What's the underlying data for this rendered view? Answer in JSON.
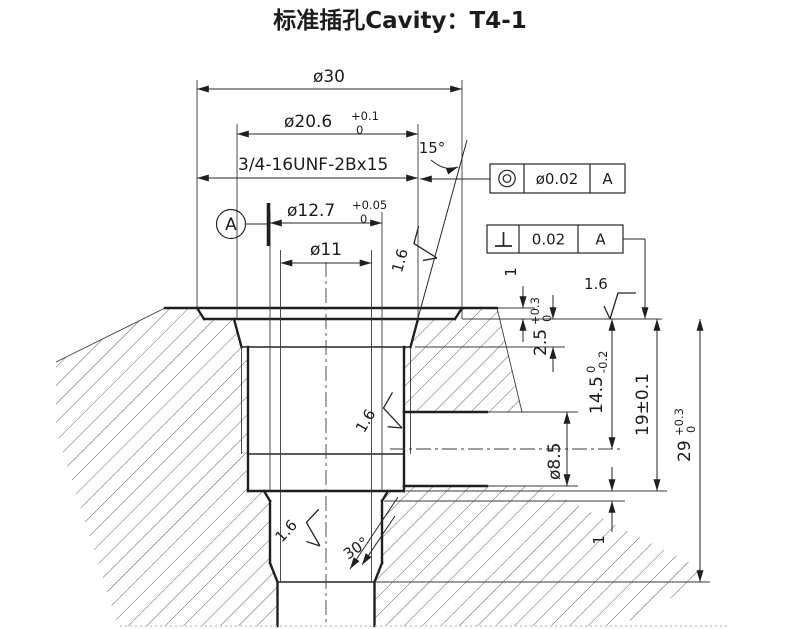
{
  "title": "标准插孔Cavity：T4-1",
  "dims": {
    "dia30": "ø30",
    "dia206": {
      "main": "ø20.6",
      "up": "+0.1",
      "low": "0"
    },
    "angle15": "15°",
    "thread": "3/4-16UNF-2Bx15",
    "dia127": {
      "main": "ø12.7",
      "up": "+0.05",
      "low": "0"
    },
    "dia11": "ø11",
    "depth1_top": "1",
    "depth25": {
      "main": "2.5",
      "up": "+0.3",
      "low": "0"
    },
    "depth145": {
      "main": "14.5",
      "up": "0",
      "low": "-0.2"
    },
    "depth19": "19±0.1",
    "depth29": {
      "main": "29",
      "up": "+0.3",
      "low": "0"
    },
    "dia85": "ø8.5",
    "depth1_bottom": "1",
    "angle30": "30°",
    "finish": "1.6"
  },
  "datum": {
    "label": "A"
  },
  "fcf_concentricity": {
    "tolerance": "ø0.02",
    "datum": "A"
  },
  "fcf_perpendicularity": {
    "tolerance": "0.02",
    "datum": "A"
  },
  "colors": {
    "line": "#1f1f1f",
    "hatch": "#4d4d4d",
    "dim": "#262626"
  }
}
